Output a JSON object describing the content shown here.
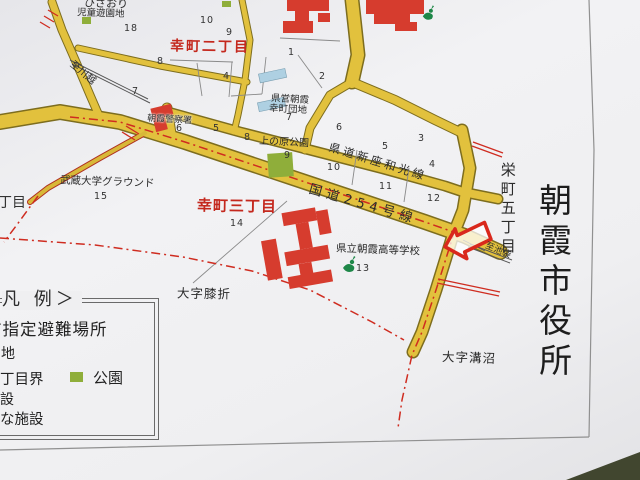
{
  "map": {
    "title": "朝霞市役所",
    "labels": {
      "hizaori_park_line1": "ひざおり",
      "hizaori_park_line2": "児童遊園地",
      "sachicho_2chome": "幸町二丁目",
      "sachicho_3chome": "幸町三丁目",
      "danchi_line1": "県営朝霞",
      "danchi_line2": "幸町団地",
      "police_station": "朝霞警察署",
      "uenohara_park": "上の原公園",
      "musashi_univ_ground": "武蔵大学グラウンド",
      "prefectural_highschool": "県立朝霞高等学校",
      "oaza_hizaori": "大字膝折",
      "oaza_mizonuma": "大字溝沼",
      "sakaecho_5chome": "栄町五丁目",
      "chome_partial": "丁目",
      "route_254": "国道254号線",
      "kendo_niiza_wako": "県道新座和光線",
      "to_kawagoe": "至川越",
      "to_ikebukuro": "至池袋"
    },
    "blocks": [
      "18",
      "10",
      "9",
      "8",
      "4",
      "1",
      "2",
      "7",
      "5",
      "6",
      "7",
      "6",
      "8",
      "9",
      "10",
      "5",
      "3",
      "4",
      "11",
      "12",
      "13",
      "14",
      "15"
    ],
    "legend": {
      "title": "凡 例＞",
      "rows": [
        "市指定避難場所",
        "地",
        "丁目界",
        "公園",
        "設",
        "な施設"
      ]
    },
    "colors": {
      "road": "#e2c13d",
      "public_building": "#d63c2e",
      "park": "#8fae3a",
      "housing_complex": "#aed0e2",
      "boundary_line": "#cf2c20",
      "district_text": "#c4281e"
    }
  }
}
